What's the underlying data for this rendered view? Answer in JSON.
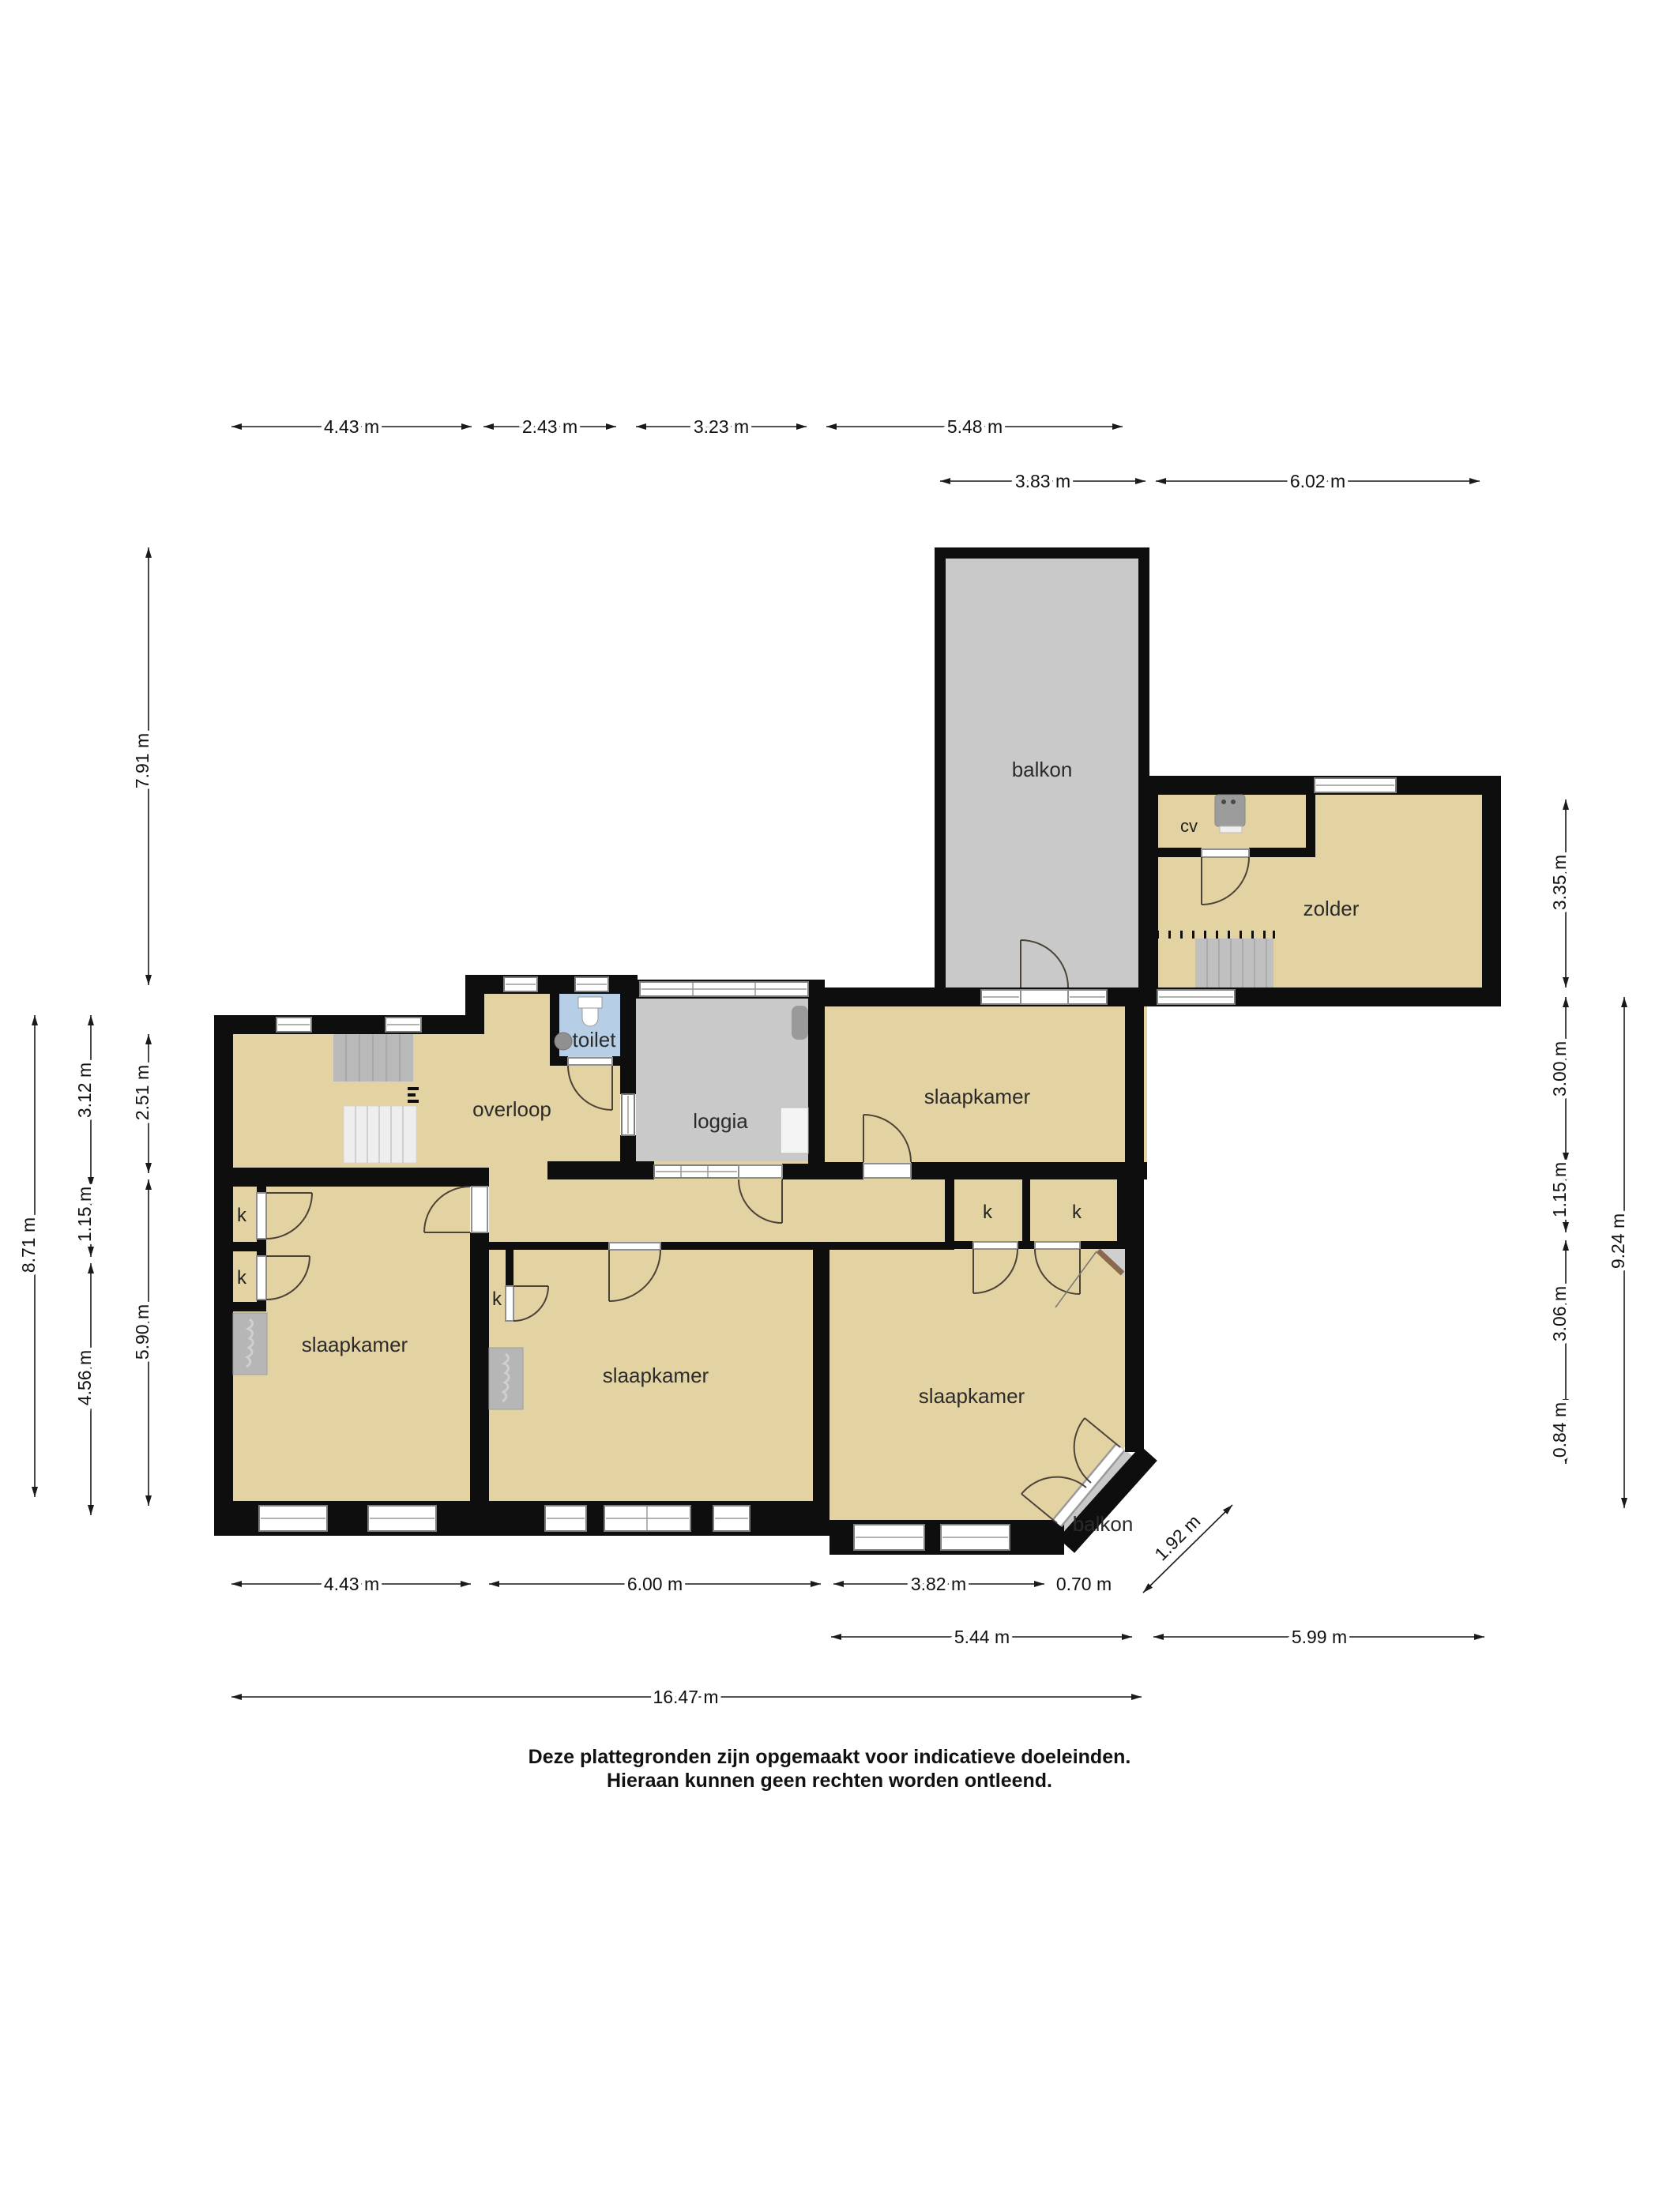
{
  "plan_type": "floor-plan",
  "rooms": [
    {
      "id": "balkon-large",
      "label": "balkon"
    },
    {
      "id": "zolder",
      "label": "zolder"
    },
    {
      "id": "cv",
      "label": "cv"
    },
    {
      "id": "toilet",
      "label": "toilet"
    },
    {
      "id": "loggia",
      "label": "loggia"
    },
    {
      "id": "overloop",
      "label": "overloop"
    },
    {
      "id": "slaapkamer-top-right",
      "label": "slaapkamer"
    },
    {
      "id": "slaapkamer-left",
      "label": "slaapkamer"
    },
    {
      "id": "slaapkamer-middle",
      "label": "slaapkamer"
    },
    {
      "id": "slaapkamer-bottom-right",
      "label": "slaapkamer"
    },
    {
      "id": "balkon-small",
      "label": "balkon"
    }
  ],
  "closets": [
    "k",
    "k",
    "k",
    "k",
    "k"
  ],
  "dimensions": {
    "top": [
      "4.43 m",
      "2.43 m",
      "3.23 m",
      "5.48 m"
    ],
    "top2": [
      "3.83 m",
      "6.02 m"
    ],
    "bottom": [
      "4.43 m",
      "6.00 m",
      "3.82 m",
      "0.70 m"
    ],
    "bottom2": [
      "5.44 m",
      "5.99 m"
    ],
    "bottom3": [
      "16.47 m"
    ],
    "diagonal": [
      "1.92 m"
    ],
    "left": [
      "7.91 m",
      "8.71 m",
      "3.12 m",
      "1.15 m",
      "4.56 m",
      "2.51 m",
      "5.90 m"
    ],
    "right": [
      "3.35 m",
      "3.00 m",
      "1.15 m",
      "3.06 m",
      "0.84 m",
      "9.24 m"
    ]
  },
  "footer": {
    "line1": "Deze plattegronden zijn opgemaakt voor indicatieve doeleinden.",
    "line2": "Hieraan kunnen geen rechten worden ontleend."
  },
  "colors": {
    "floor": "#e4d3a2",
    "outdoor_floor": "#c9c9c9",
    "toilet_floor": "#b7cfe6",
    "wall": "#0e0e0e"
  }
}
